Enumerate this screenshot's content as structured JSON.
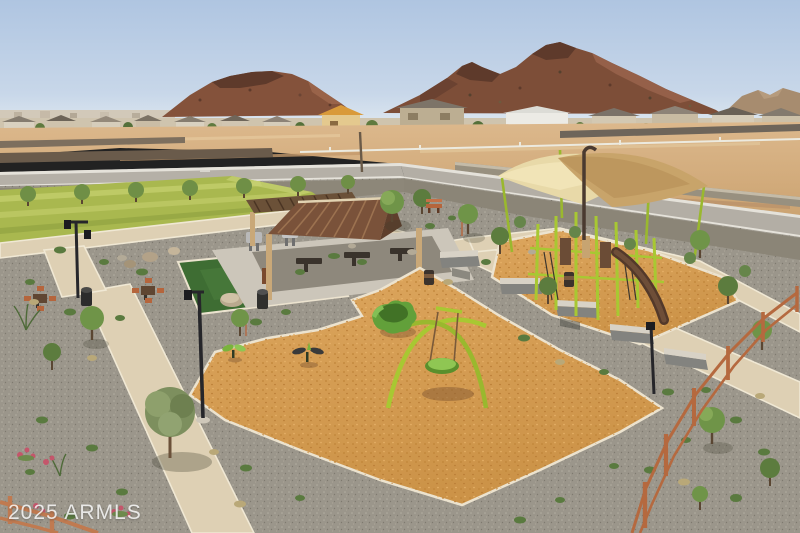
{
  "watermark": {
    "text": "2025 ARMLS"
  },
  "scene": {
    "type": "aerial-photo",
    "subject": "new-build desert community park with playground",
    "objects": [
      "sky",
      "desert-mountains",
      "distant-hills",
      "home-rooftops",
      "vacant-dirt-lots",
      "block-walls",
      "street",
      "street-trees",
      "turf-lawn",
      "artificial-turf-square",
      "concrete-paths",
      "picnic-ramada",
      "bbq-grills",
      "picnic-tables",
      "game-tables",
      "shade-sail-play-structure",
      "slide",
      "arch-swing-set",
      "saucer-swing",
      "flower-spinner",
      "spring-riders",
      "wood-fiber-mulch",
      "seat-walls",
      "boulders",
      "desert-shrubs",
      "young-trees",
      "olive-tree",
      "lamp-posts",
      "trash-cans",
      "rust-steel-fence",
      "pink-flowering-shrubs"
    ]
  },
  "palette": {
    "sky_top": "#afc5e1",
    "sky_horizon": "#dde7f0",
    "mountain": "#7d4e38",
    "mountain_shadow": "#5e3a2b",
    "dirt": "#d7b083",
    "road": "#b5b0a7",
    "lawn": "#a9b84f",
    "turf_square": "#3e6d33",
    "gravel": "#9b968b",
    "path_concrete": "#ded0b4",
    "mulch": "#d59b52",
    "play_equipment_lime": "#a8c832",
    "play_green": "#62a03a",
    "shade_sail_light": "#e8d9a8",
    "shade_sail_dark": "#c8a46a",
    "ramada_roof": "#7a523a",
    "ramada_wood": "#c9a878",
    "fence_rust": "#b5693f",
    "watermark_color": "#ffffff"
  }
}
